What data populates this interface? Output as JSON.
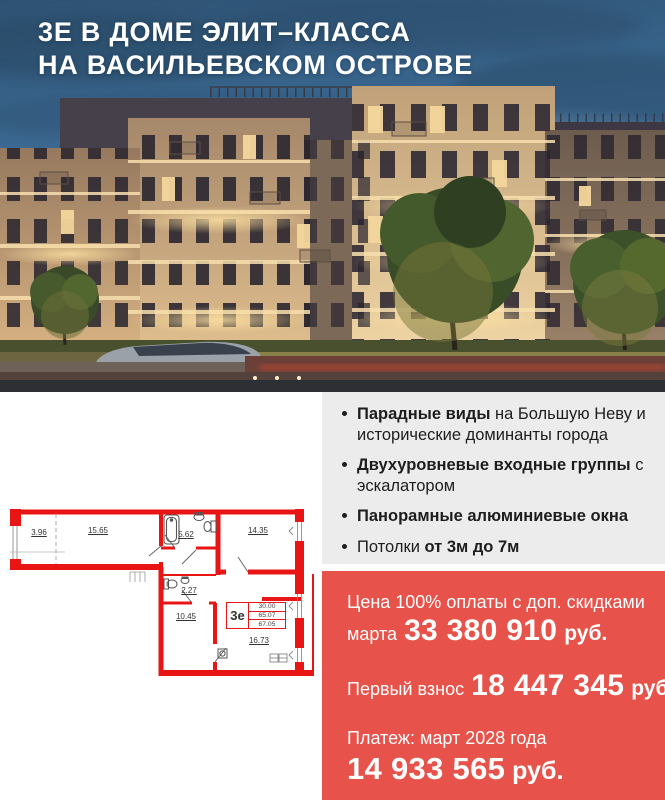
{
  "header": {
    "title_line1": "3Е В ДОМЕ ЭЛИТ–КЛАССА",
    "title_line2": "НА ВАСИЛЬЕВСКОМ ОСТРОВЕ"
  },
  "features": {
    "items": [
      {
        "pre": "",
        "bold": "Парадные виды",
        "post": " на Большую Неву и исторические доминанты города"
      },
      {
        "pre": "",
        "bold": "Двухуровневые входные группы",
        "post": " с эскалатором"
      },
      {
        "pre": "",
        "bold": "Панорамные алюминиевые окна",
        "post": ""
      },
      {
        "pre": "Потолки ",
        "bold": "от 3м до 7м",
        "post": ""
      }
    ]
  },
  "pricing": {
    "full_payment": {
      "label_line1": "Цена 100% оплаты с доп. скидками",
      "label_line2": "марта",
      "amount": "33 380 910",
      "currency": "руб."
    },
    "first_installment": {
      "label": "Первый взнос",
      "amount": "18 447 345",
      "currency": "руб."
    },
    "final_payment": {
      "label": "Платеж: март 2028 года",
      "amount": "14 933 565",
      "currency": "руб."
    }
  },
  "floorplan": {
    "rooms": {
      "balcony": "3.96",
      "room1": "15.65",
      "bathroom": "5.62",
      "room2": "14.35",
      "wc": "2.27",
      "hall": "10.45",
      "room3": "16.73"
    },
    "info_table": {
      "type": "3е",
      "values": [
        "30.00",
        "65.07",
        "67.05"
      ]
    }
  },
  "colors": {
    "accent_red": "#E7534A",
    "panel_gray": "#ECECEC",
    "plan_red": "#E91414",
    "headline_white": "#FFFFFF"
  }
}
